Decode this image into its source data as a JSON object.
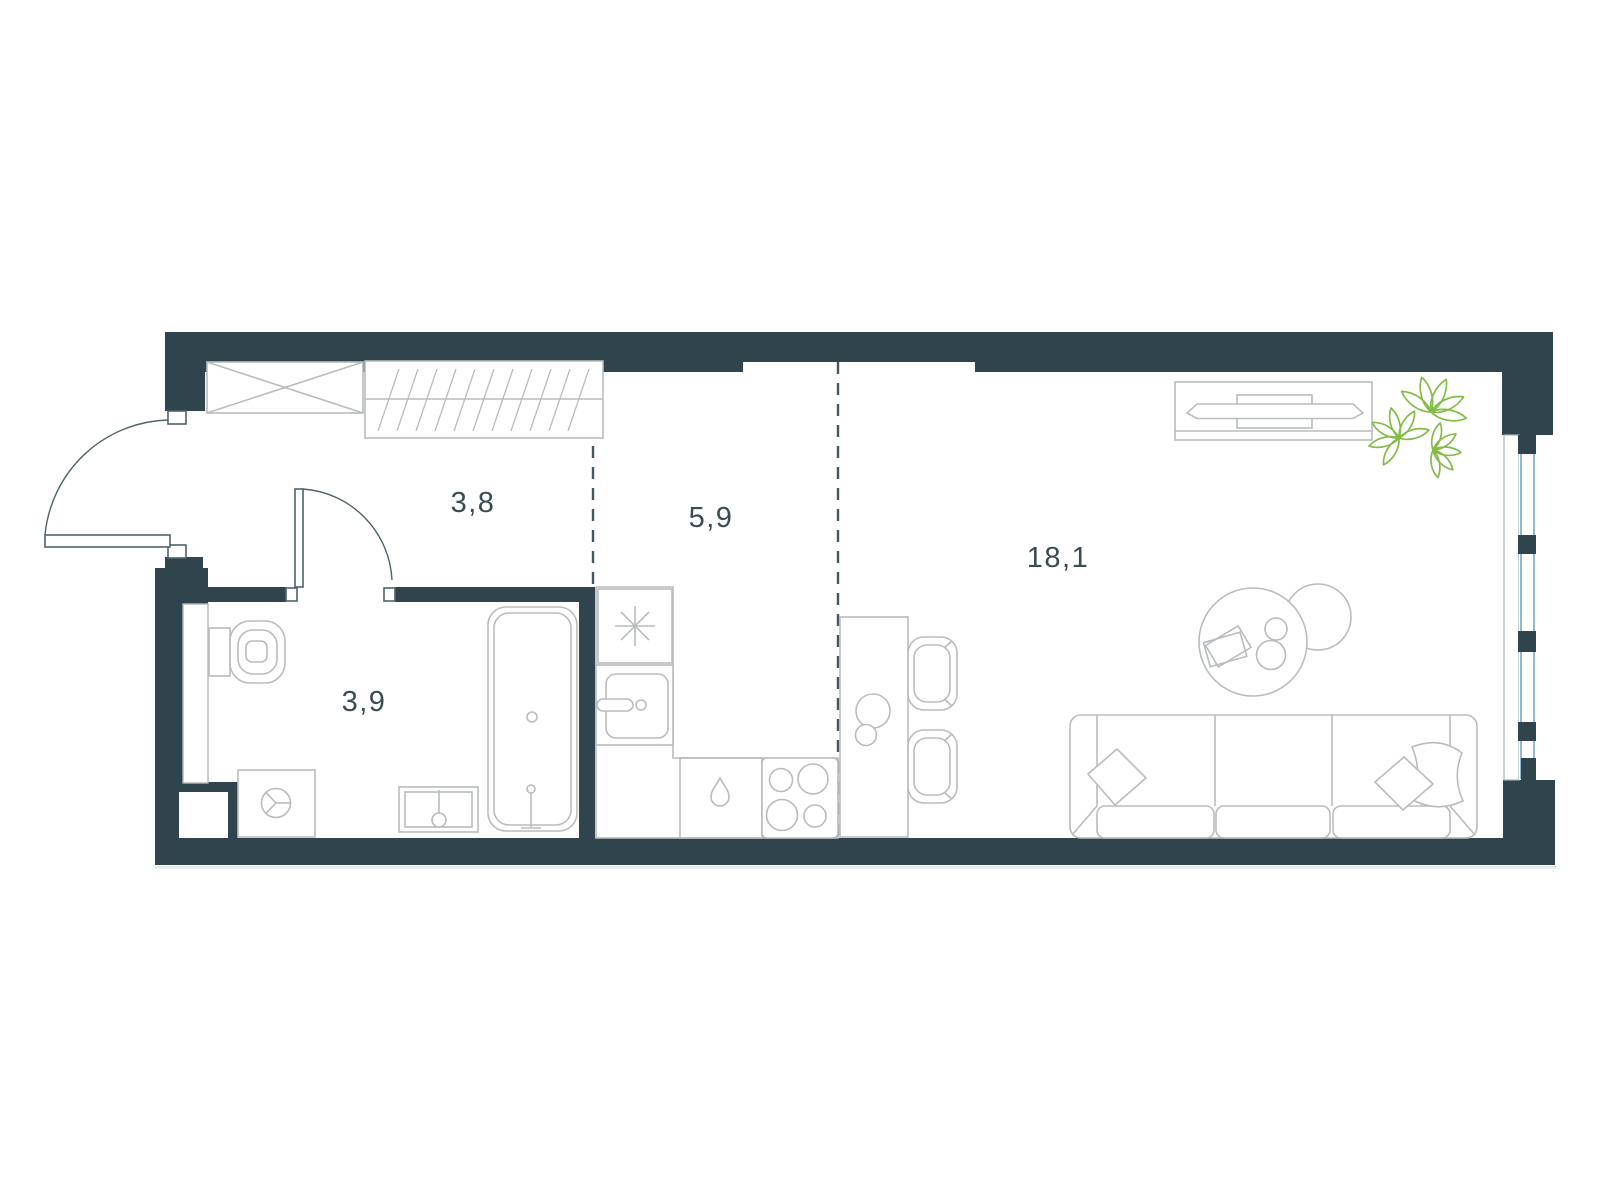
{
  "plan": {
    "type": "apartment-floor-plan",
    "rooms": [
      {
        "name": "hallway",
        "area_label": "3,8"
      },
      {
        "name": "kitchen",
        "area_label": "5,9"
      },
      {
        "name": "bathroom",
        "area_label": "3,9"
      },
      {
        "name": "living-room",
        "area_label": "18,1"
      }
    ],
    "fixtures": [
      "entrance-door",
      "bathroom-door",
      "crossed-closet",
      "hatched-wardrobe",
      "toilet",
      "washing-machine",
      "washbasin",
      "bathtub",
      "refrigerator",
      "kitchen-sink",
      "dishwasher-cabinet",
      "cooktop",
      "bar-counter",
      "bar-chair",
      "bar-chair",
      "decanter",
      "tv-console",
      "tv",
      "plant",
      "coffee-table",
      "side-table",
      "sofa",
      "pillow",
      "window"
    ],
    "colors": {
      "wall": "#2f444c",
      "furniture_outline": "#b8bcbe",
      "door_line": "#50626a",
      "dashed_zone_line": "#44565e",
      "window_glass": "#8fb9d6",
      "plant_green": "#84bc49",
      "label_text": "#3b4b53",
      "background": "#ffffff",
      "slab_shadow": "#dde9ec"
    }
  }
}
